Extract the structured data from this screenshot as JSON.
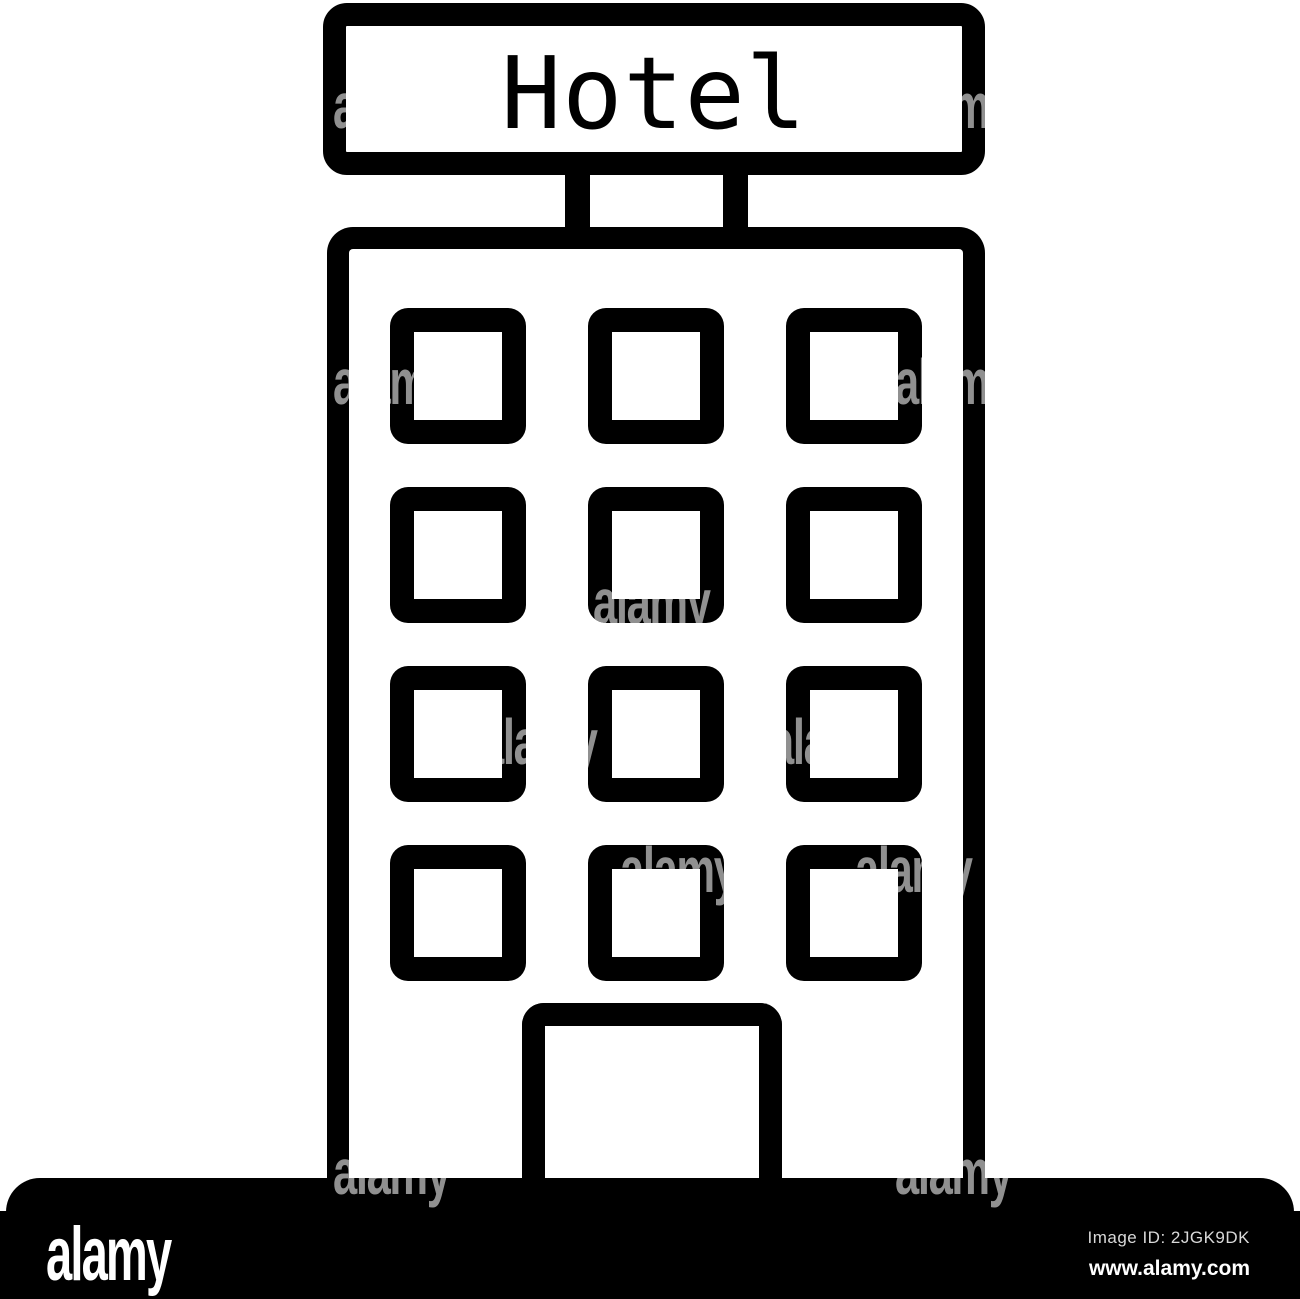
{
  "icon": {
    "description": "hotel-building-line-icon",
    "stroke_color": "#000000",
    "background_color": "#ffffff",
    "sign": {
      "text": "Hotel"
    },
    "windows_grid": {
      "rows": 4,
      "cols": 3,
      "col_x": [
        390,
        588,
        786
      ],
      "row_y": [
        308,
        487,
        666,
        845
      ]
    }
  },
  "watermark": {
    "text": "alamy",
    "color": "#909090",
    "positions": [
      [
        333,
        74
      ],
      [
        895,
        74
      ],
      [
        333,
        350
      ],
      [
        895,
        350
      ],
      [
        593,
        570
      ],
      [
        480,
        710
      ],
      [
        770,
        710
      ],
      [
        620,
        838
      ],
      [
        855,
        838
      ],
      [
        333,
        1140
      ],
      [
        895,
        1140
      ]
    ]
  },
  "footer": {
    "logo_text": "alamy",
    "image_id_label": "Image ID: 2JGK9DK",
    "website": "www.alamy.com",
    "bar_color": "#000000"
  }
}
